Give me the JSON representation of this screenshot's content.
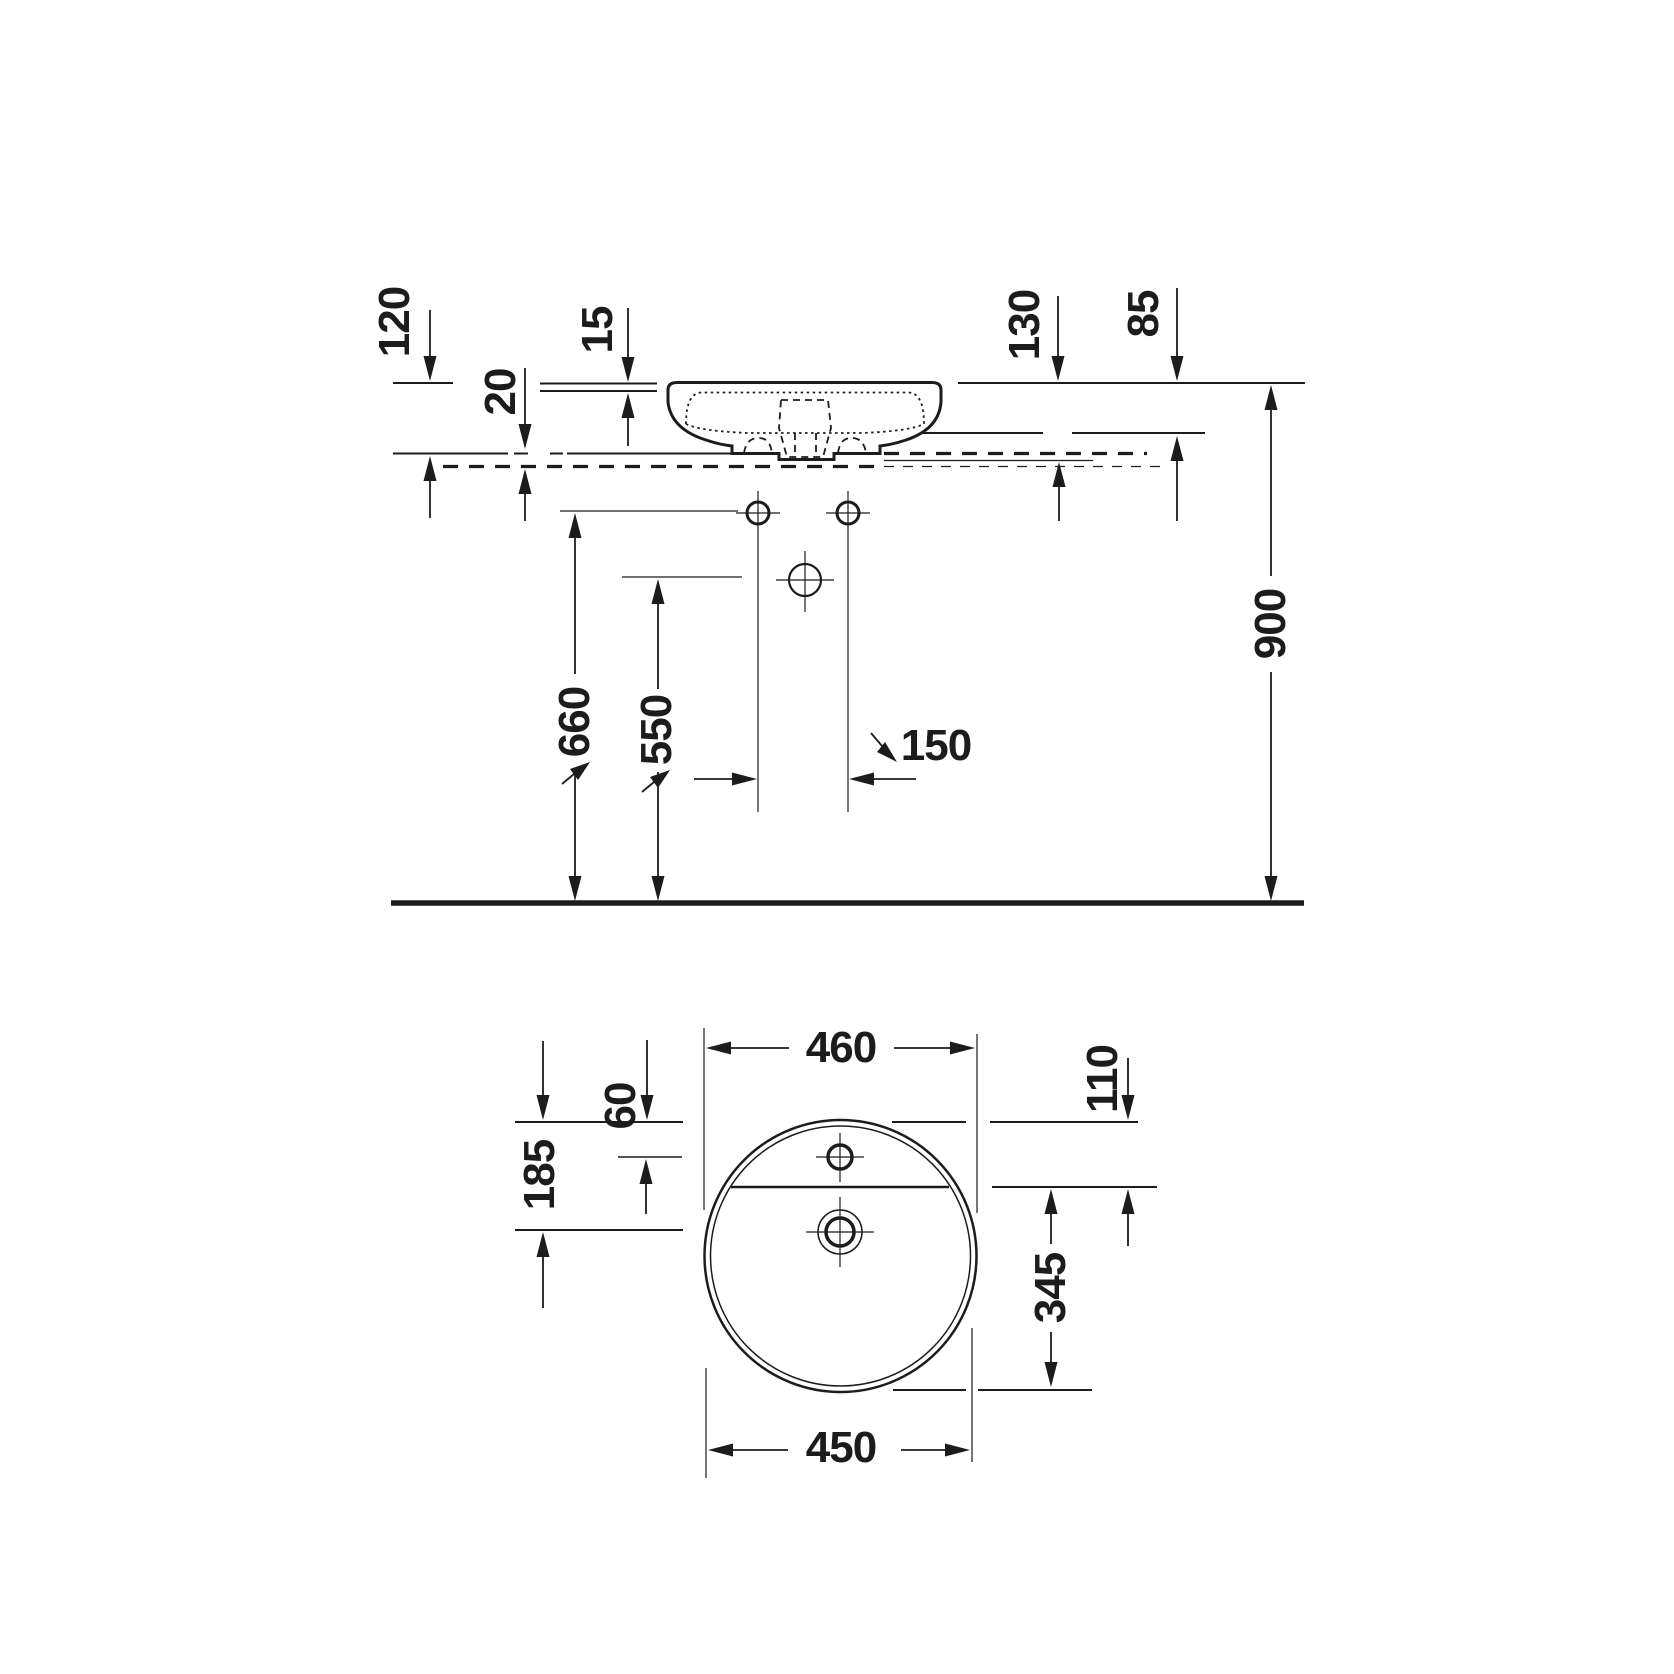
{
  "colors": {
    "ink": "#1c1c1c",
    "background": "#ffffff"
  },
  "elevation": {
    "dim_120": "120",
    "dim_20": "20",
    "dim_15": "15",
    "dim_130": "130",
    "dim_85": "85",
    "dim_900": "900",
    "dim_660": "660",
    "dim_550": "550",
    "dim_150": "150"
  },
  "plan": {
    "dim_460": "460",
    "dim_110": "110",
    "dim_60": "60",
    "dim_185": "185",
    "dim_345": "345",
    "dim_450": "450"
  }
}
